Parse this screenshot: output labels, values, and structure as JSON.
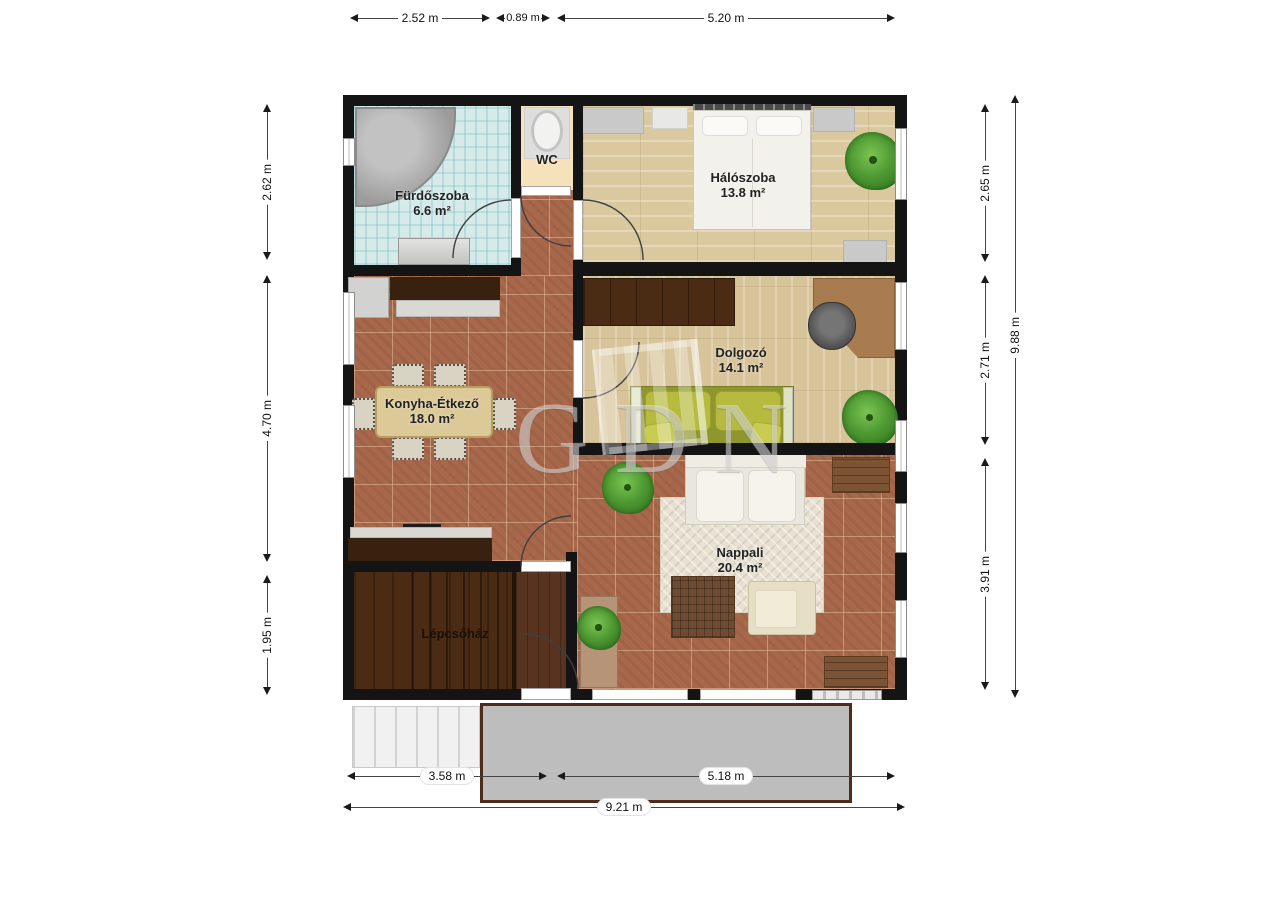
{
  "watermark": {
    "text": "GDN"
  },
  "rooms": {
    "furdoszoba": {
      "label": "Fürdőszoba",
      "area": "6.6 m²"
    },
    "wc": {
      "label": "WC"
    },
    "haloszoba": {
      "label": "Hálószoba",
      "area": "13.8 m²"
    },
    "dolgozo": {
      "label": "Dolgozó",
      "area": "14.1 m²"
    },
    "konyha_etkezo": {
      "label": "Konyha-Étkező",
      "area": "18.0 m²"
    },
    "nappali": {
      "label": "Nappali",
      "area": "20.4 m²"
    },
    "lepcsohaz": {
      "label": "Lépcsőház"
    }
  },
  "dims": {
    "top": [
      "2.52 m",
      "0.89 m",
      "5.20 m"
    ],
    "left": [
      "2.62 m",
      "4.70 m",
      "1.95 m"
    ],
    "right": [
      "2.65 m",
      "2.71 m",
      "3.91 m"
    ],
    "right_total": "9.88 m",
    "bottom": [
      "3.58 m",
      "5.18 m"
    ],
    "bottom_total": "9.21 m"
  },
  "colors": {
    "wall": "#141414",
    "bathroom_tile": "#d6eae9",
    "wc_floor": "#f6e2ba",
    "wood_floor": "#dac89f",
    "terracotta_floor": "#a8684c",
    "dark_wood": "#4c2b15",
    "terrace": "#bdbdbd",
    "terrace_border": "#4e2c17",
    "sofa_olive": "#b6ba3e",
    "plant_green": "#4f9a33",
    "dim_text": "#111111"
  }
}
